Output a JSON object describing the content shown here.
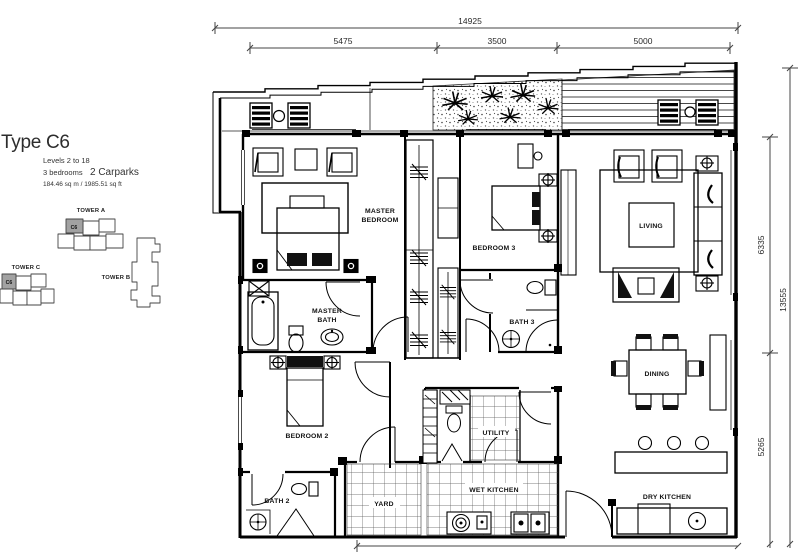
{
  "header": {
    "title": "Type C6",
    "levels": "Levels 2 to 18",
    "bedrooms": "3 bedrooms",
    "carparks": "2 Carparks",
    "area": "184.46 sq m / 1985.51 sq ft"
  },
  "keyplan": {
    "tower_a_label": "TOWER A",
    "tower_b_label": "TOWER B",
    "tower_c_label": "TOWER C",
    "unit_label": "C6",
    "highlight_color": "#a2a2a2"
  },
  "dimensions": {
    "top_overall": "14925",
    "top_segments": [
      "5475",
      "3500",
      "5000"
    ],
    "right_overall": "13555",
    "right_segments": [
      "6335",
      "5265"
    ]
  },
  "rooms": {
    "master_bedroom": {
      "line1": "MASTER",
      "line2": "BEDROOM"
    },
    "bedroom3": "BEDROOM 3",
    "living": "LIVING",
    "master_bath": {
      "line1": "MASTER",
      "line2": "BATH"
    },
    "bath3": "BATH 3",
    "dining": "DINING",
    "bedroom2": "BEDROOM 2",
    "utility": "UTILITY",
    "bath2": "BATH 2",
    "yard": "YARD",
    "wet_kitchen": "WET KITCHEN",
    "dry_kitchen": "DRY KITCHEN"
  }
}
